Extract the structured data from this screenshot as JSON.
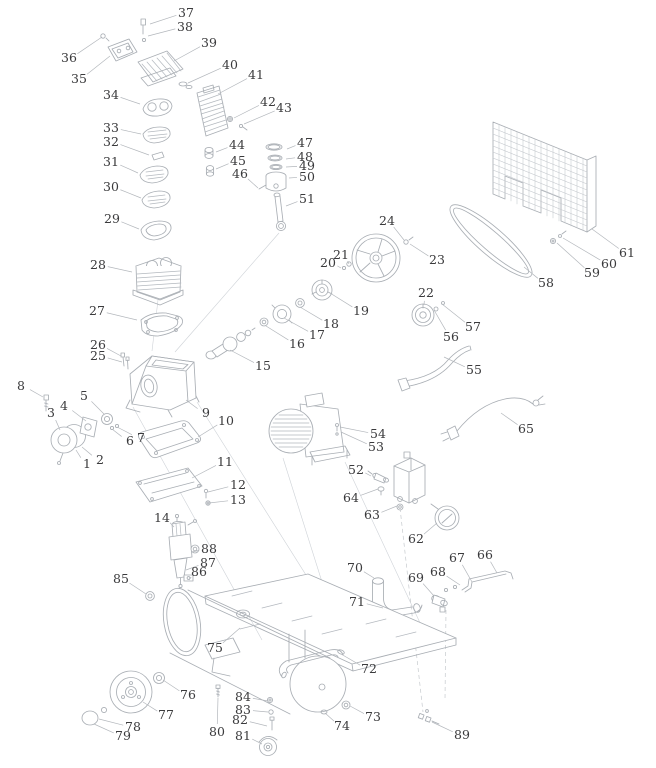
{
  "diagram": {
    "type": "exploded-parts-diagram",
    "subject": "air-compressor",
    "background_color": "#ffffff",
    "line_color": "#a9aeb4",
    "leader_color": "#b3b7bc",
    "label_color": "#3a3a3c",
    "part_count": 89,
    "labels": [
      {
        "n": "1",
        "x": 87,
        "y": 464,
        "tx": 76,
        "ty": 450
      },
      {
        "n": "2",
        "x": 100,
        "y": 460,
        "tx": 82,
        "ty": 447
      },
      {
        "n": "3",
        "x": 51,
        "y": 413,
        "tx": 60,
        "ty": 430
      },
      {
        "n": "4",
        "x": 64,
        "y": 406,
        "tx": 86,
        "ty": 421
      },
      {
        "n": "5",
        "x": 84,
        "y": 396,
        "tx": 104,
        "ty": 414
      },
      {
        "n": "6",
        "x": 130,
        "y": 441,
        "tx": 112,
        "ty": 429
      },
      {
        "n": "7",
        "x": 141,
        "y": 438,
        "tx": 117,
        "ty": 427
      },
      {
        "n": "8",
        "x": 21,
        "y": 386,
        "tx": 43,
        "ty": 397
      },
      {
        "n": "9",
        "x": 206,
        "y": 413,
        "tx": 186,
        "ty": 400
      },
      {
        "n": "10",
        "x": 226,
        "y": 421,
        "tx": 198,
        "ty": 437
      },
      {
        "n": "11",
        "x": 225,
        "y": 462,
        "tx": 192,
        "ty": 478
      },
      {
        "n": "12",
        "x": 238,
        "y": 485,
        "tx": 208,
        "ty": 492
      },
      {
        "n": "13",
        "x": 238,
        "y": 500,
        "tx": 209,
        "ty": 503
      },
      {
        "n": "14",
        "x": 162,
        "y": 518,
        "tx": 174,
        "ty": 527
      },
      {
        "n": "15",
        "x": 263,
        "y": 366,
        "tx": 230,
        "ty": 350
      },
      {
        "n": "16",
        "x": 297,
        "y": 344,
        "tx": 266,
        "ty": 326
      },
      {
        "n": "17",
        "x": 317,
        "y": 335,
        "tx": 284,
        "ty": 318
      },
      {
        "n": "18",
        "x": 331,
        "y": 324,
        "tx": 300,
        "ty": 307
      },
      {
        "n": "19",
        "x": 361,
        "y": 311,
        "tx": 330,
        "ty": 293
      },
      {
        "n": "20",
        "x": 328,
        "y": 263,
        "tx": 341,
        "ty": 268
      },
      {
        "n": "21",
        "x": 341,
        "y": 255,
        "tx": 349,
        "ty": 264
      },
      {
        "n": "22",
        "x": 426,
        "y": 293,
        "tx": 424,
        "ty": 305
      },
      {
        "n": "23",
        "x": 437,
        "y": 260,
        "tx": 410,
        "ty": 244
      },
      {
        "n": "24",
        "x": 387,
        "y": 221,
        "tx": 404,
        "ty": 240
      },
      {
        "n": "25",
        "x": 98,
        "y": 356,
        "tx": 122,
        "ty": 362
      },
      {
        "n": "26",
        "x": 98,
        "y": 345,
        "tx": 121,
        "ty": 356
      },
      {
        "n": "27",
        "x": 97,
        "y": 311,
        "tx": 137,
        "ty": 320
      },
      {
        "n": "28",
        "x": 98,
        "y": 265,
        "tx": 132,
        "ty": 272
      },
      {
        "n": "29",
        "x": 112,
        "y": 219,
        "tx": 139,
        "ty": 229
      },
      {
        "n": "30",
        "x": 111,
        "y": 187,
        "tx": 141,
        "ty": 198
      },
      {
        "n": "31",
        "x": 111,
        "y": 162,
        "tx": 138,
        "ty": 173
      },
      {
        "n": "32",
        "x": 111,
        "y": 142,
        "tx": 149,
        "ty": 155
      },
      {
        "n": "33",
        "x": 111,
        "y": 128,
        "tx": 141,
        "ty": 134
      },
      {
        "n": "34",
        "x": 111,
        "y": 95,
        "tx": 140,
        "ty": 104
      },
      {
        "n": "35",
        "x": 79,
        "y": 79,
        "tx": 110,
        "ty": 56
      },
      {
        "n": "36",
        "x": 69,
        "y": 58,
        "tx": 102,
        "ty": 37
      },
      {
        "n": "37",
        "x": 186,
        "y": 13,
        "tx": 150,
        "ty": 24
      },
      {
        "n": "38",
        "x": 185,
        "y": 27,
        "tx": 148,
        "ty": 36
      },
      {
        "n": "39",
        "x": 209,
        "y": 43,
        "tx": 174,
        "ty": 61
      },
      {
        "n": "40",
        "x": 230,
        "y": 65,
        "tx": 188,
        "ty": 83
      },
      {
        "n": "41",
        "x": 256,
        "y": 75,
        "tx": 218,
        "ty": 94
      },
      {
        "n": "42",
        "x": 268,
        "y": 102,
        "tx": 234,
        "ty": 118
      },
      {
        "n": "43",
        "x": 284,
        "y": 108,
        "tx": 244,
        "ty": 124
      },
      {
        "n": "44",
        "x": 237,
        "y": 145,
        "tx": 216,
        "ty": 152
      },
      {
        "n": "45",
        "x": 238,
        "y": 161,
        "tx": 216,
        "ty": 169
      },
      {
        "n": "46",
        "x": 240,
        "y": 174,
        "tx": 258,
        "ty": 188
      },
      {
        "n": "47",
        "x": 305,
        "y": 143,
        "tx": 287,
        "ty": 149
      },
      {
        "n": "48",
        "x": 305,
        "y": 157,
        "tx": 286,
        "ty": 159
      },
      {
        "n": "49",
        "x": 307,
        "y": 166,
        "tx": 286,
        "ty": 167
      },
      {
        "n": "50",
        "x": 307,
        "y": 177,
        "tx": 289,
        "ty": 178
      },
      {
        "n": "51",
        "x": 307,
        "y": 199,
        "tx": 286,
        "ty": 206
      },
      {
        "n": "52",
        "x": 356,
        "y": 470,
        "tx": 371,
        "ty": 476
      },
      {
        "n": "53",
        "x": 376,
        "y": 447,
        "tx": 341,
        "ty": 432
      },
      {
        "n": "54",
        "x": 378,
        "y": 434,
        "tx": 340,
        "ty": 427
      },
      {
        "n": "55",
        "x": 474,
        "y": 370,
        "tx": 444,
        "ty": 357
      },
      {
        "n": "56",
        "x": 451,
        "y": 337,
        "tx": 434,
        "ty": 310
      },
      {
        "n": "57",
        "x": 473,
        "y": 327,
        "tx": 442,
        "ty": 304
      },
      {
        "n": "58",
        "x": 546,
        "y": 283,
        "tx": 524,
        "ty": 267
      },
      {
        "n": "59",
        "x": 592,
        "y": 273,
        "tx": 557,
        "ty": 243
      },
      {
        "n": "60",
        "x": 609,
        "y": 264,
        "tx": 563,
        "ty": 238
      },
      {
        "n": "61",
        "x": 627,
        "y": 253,
        "tx": 592,
        "ty": 229
      },
      {
        "n": "62",
        "x": 416,
        "y": 539,
        "tx": 437,
        "ty": 523
      },
      {
        "n": "63",
        "x": 372,
        "y": 515,
        "tx": 397,
        "ty": 506
      },
      {
        "n": "64",
        "x": 351,
        "y": 498,
        "tx": 378,
        "ty": 489
      },
      {
        "n": "65",
        "x": 526,
        "y": 429,
        "tx": 501,
        "ty": 413
      },
      {
        "n": "66",
        "x": 485,
        "y": 555,
        "tx": 497,
        "ty": 573
      },
      {
        "n": "67",
        "x": 457,
        "y": 558,
        "tx": 472,
        "ty": 582
      },
      {
        "n": "68",
        "x": 438,
        "y": 572,
        "tx": 460,
        "ty": 585
      },
      {
        "n": "69",
        "x": 416,
        "y": 578,
        "tx": 434,
        "ty": 596
      },
      {
        "n": "70",
        "x": 355,
        "y": 568,
        "tx": 374,
        "ty": 578
      },
      {
        "n": "71",
        "x": 357,
        "y": 602,
        "tx": 383,
        "ty": 608
      },
      {
        "n": "72",
        "x": 369,
        "y": 669,
        "tx": 341,
        "ty": 654
      },
      {
        "n": "73",
        "x": 373,
        "y": 717,
        "tx": 350,
        "ty": 706
      },
      {
        "n": "74",
        "x": 342,
        "y": 726,
        "tx": 325,
        "ty": 713
      },
      {
        "n": "75",
        "x": 215,
        "y": 648,
        "tx": 240,
        "ty": 628
      },
      {
        "n": "76",
        "x": 188,
        "y": 695,
        "tx": 163,
        "ty": 680
      },
      {
        "n": "77",
        "x": 166,
        "y": 715,
        "tx": 143,
        "ty": 702
      },
      {
        "n": "78",
        "x": 133,
        "y": 727,
        "tx": 99,
        "ty": 719
      },
      {
        "n": "79",
        "x": 123,
        "y": 736,
        "tx": 94,
        "ty": 724
      },
      {
        "n": "80",
        "x": 217,
        "y": 732,
        "tx": 218,
        "ty": 698
      },
      {
        "n": "81",
        "x": 243,
        "y": 736,
        "tx": 262,
        "ty": 744
      },
      {
        "n": "82",
        "x": 240,
        "y": 720,
        "tx": 267,
        "ty": 726
      },
      {
        "n": "83",
        "x": 243,
        "y": 710,
        "tx": 268,
        "ty": 712
      },
      {
        "n": "84",
        "x": 243,
        "y": 697,
        "tx": 268,
        "ty": 701
      },
      {
        "n": "85",
        "x": 121,
        "y": 579,
        "tx": 146,
        "ty": 594
      },
      {
        "n": "86",
        "x": 199,
        "y": 572,
        "tx": 189,
        "ty": 580
      },
      {
        "n": "87",
        "x": 208,
        "y": 563,
        "tx": 186,
        "ty": 570
      },
      {
        "n": "88",
        "x": 209,
        "y": 549,
        "tx": 192,
        "ty": 552
      },
      {
        "n": "89",
        "x": 462,
        "y": 735,
        "tx": 432,
        "ty": 722
      }
    ]
  }
}
